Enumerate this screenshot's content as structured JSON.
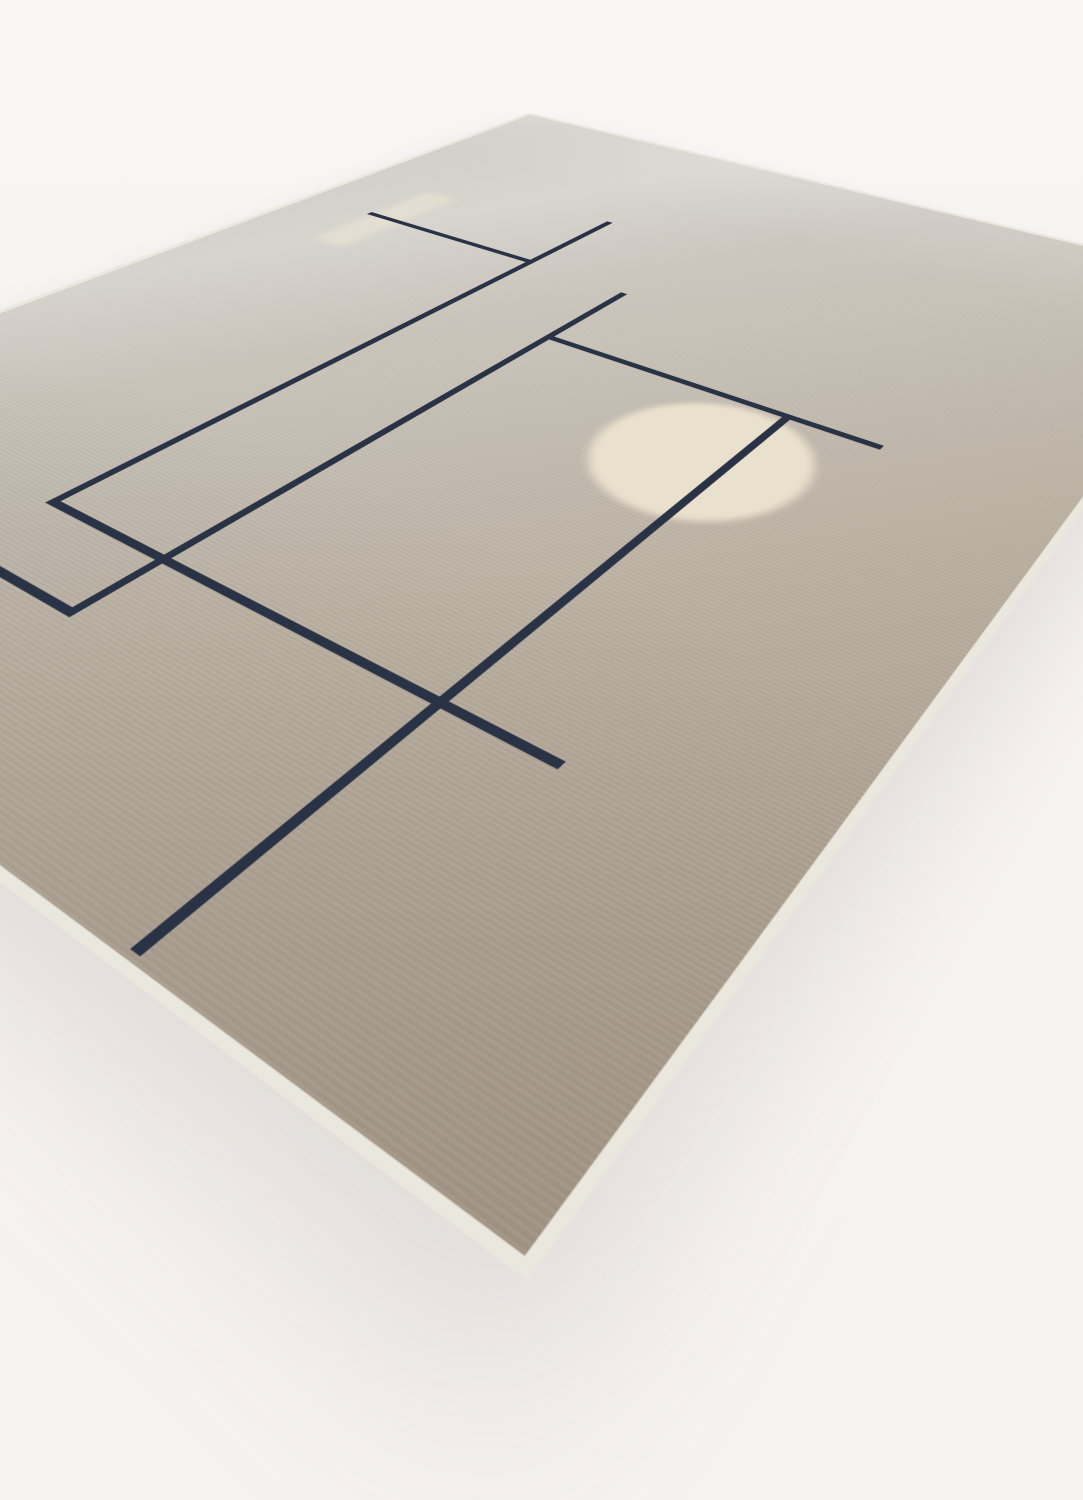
{
  "scene": {
    "type": "product-photograph",
    "subject": "Modern hand-knotted wool rug viewed at an angle on a seamless pale studio backdrop",
    "backdrop_color": "#f7f3f2",
    "no_visible_text": true
  },
  "rug": {
    "shape": "rectangle in perspective, far corner top-center, near corner bottom-center, left and right corners cropped by frame",
    "flat_size": {
      "width": 1000,
      "height": 1250
    },
    "colors": {
      "field_far": "#d8d5cf",
      "field_mid": "#c9c4bb",
      "field_near": "#a89b8b",
      "binding": "#eae7df",
      "navy": "#2a3246",
      "cream_circle": "#e9e0cd",
      "cream_stripe": "#ece4d3"
    },
    "pattern": {
      "line_thickness": 8,
      "lines": [
        {
          "id": "v1-vertical-left",
          "x": 335,
          "y": 272,
          "w": 8,
          "h": 746
        },
        {
          "id": "h1-horizontal-top",
          "x": 94,
          "y": 417,
          "w": 249,
          "h": 8
        },
        {
          "id": "h3-horizontal-middle",
          "x": 335,
          "y": 1010,
          "w": 503,
          "h": 8
        },
        {
          "id": "v3-vertical-second",
          "x": 466,
          "y": 428,
          "w": 8,
          "h": 667
        },
        {
          "id": "h4-horizontal-lower",
          "x": 20,
          "y": 1087,
          "w": 454,
          "h": 8
        },
        {
          "id": "h2-horizontal-upper",
          "x": 468,
          "y": 553,
          "w": 364,
          "h": 8
        },
        {
          "id": "v2-vertical-long",
          "x": 736,
          "y": 553,
          "w": 8,
          "h": 692
        }
      ],
      "accents": [
        {
          "id": "cream-circle",
          "kind": "circle",
          "x": 620,
          "y": 567,
          "w": 190,
          "h": 190,
          "color_key": "cream_circle"
        },
        {
          "id": "cream-stripe",
          "kind": "stripe",
          "x": 100,
          "y": 325,
          "w": 44,
          "h": 190,
          "color_key": "cream_stripe"
        }
      ],
      "junctions": [
        "h1 right end meets v1 (T)",
        "v1 bottom turns right into h3 (L corner)",
        "h3 crosses v3 and v2, free right end",
        "v3 free top, h2 starts on v3 (T), v3 bottom turns left into h4 (L corner)",
        "v2 starts on h2 (T), passes through cream circle, free lower end near rug edge"
      ]
    }
  }
}
